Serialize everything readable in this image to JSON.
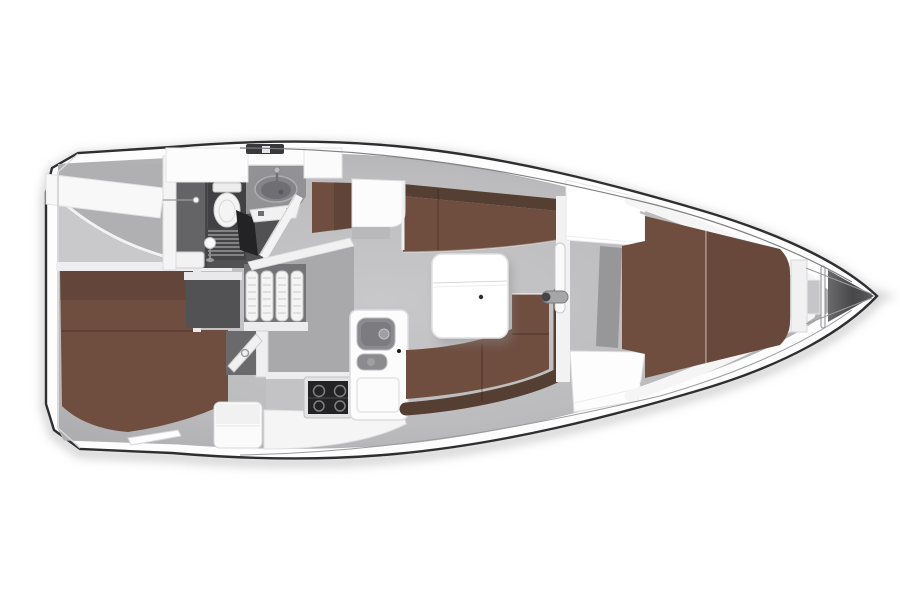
{
  "page": {
    "background": "#ffffff"
  },
  "diagram": {
    "title": "Sailing yacht interior layout — overhead plan",
    "description": "Top-down cutaway floor plan of a sailing yacht with the bow pointing right: aft double cabin, wet head with shower, companionway steps, L-shaped galley with stove and twin sinks, salon with facing settees and folding table, navigator seat, wardrobe, forward V-berth cabin and anchor locker.",
    "bow_direction": "right",
    "areas": [
      {
        "id": "aft-cabin",
        "label": "Aft double cabin"
      },
      {
        "id": "head",
        "label": "Wet head with toilet, basin and shower"
      },
      {
        "id": "companionway",
        "label": "Companionway steps"
      },
      {
        "id": "galley",
        "label": "L-galley with stove and twin sinks"
      },
      {
        "id": "salon",
        "label": "Salon with facing settees and folding table"
      },
      {
        "id": "nav-station",
        "label": "Navigator seat and desk"
      },
      {
        "id": "wardrobe",
        "label": "Wardrobe lockers"
      },
      {
        "id": "forward-cabin",
        "label": "Forward V-berth cabin"
      },
      {
        "id": "anchor-locker",
        "label": "Anchor locker"
      },
      {
        "id": "transom",
        "label": "Stern transom with swim steps"
      }
    ]
  },
  "colors": {
    "hull_outline": "#2f2f31",
    "deck": "#fbfbfc",
    "floor": "#bcbcbe",
    "counter": "#a9a9ac",
    "head_floor": "#515154",
    "upholstery": "#6f4e40",
    "upholstery_dark": "#553e32",
    "stove": "#232325",
    "table": "#ffffff",
    "shadow": "#bdbdbf"
  }
}
